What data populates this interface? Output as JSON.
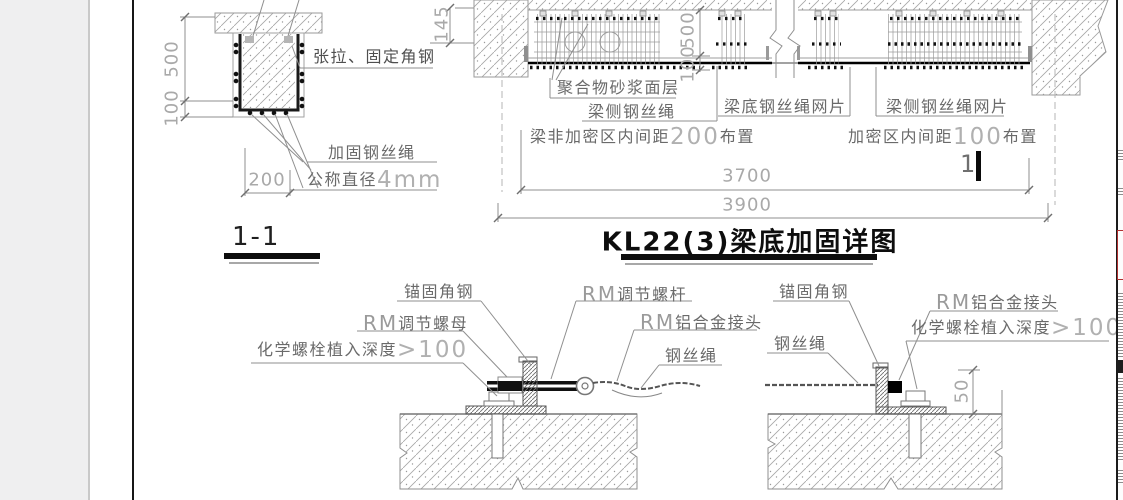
{
  "colors": {
    "line_gray": "#8f8f8f",
    "dim_gray": "#a9a9a9",
    "label_gray": "#6a6a6a",
    "ink_black": "#111111",
    "red_accent": "#b03030",
    "sidebar_gray": "#efeff0"
  },
  "s11": {
    "name": "1-1",
    "d500": "500",
    "d100": "100",
    "d200": "200",
    "tension": "张拉、固定角钢",
    "rope": "加固钢丝绳",
    "dia_prefix": "公称直径",
    "dia_num": "4mm"
  },
  "elev": {
    "title": "KL22(3)梁底加固详图",
    "d145": "145",
    "d500": "500",
    "d100": "100",
    "d3700": "3700",
    "d3900": "3900",
    "mortar": "聚合物砂浆面层",
    "side_rope": "梁侧钢丝绳",
    "bottom_mesh": "梁底钢丝绳网片",
    "side_mesh": "梁侧钢丝绳网片",
    "sp1_prefix": "梁非加密区内间距",
    "sp1_num": "200",
    "sp1_suffix": "布置",
    "sp2_prefix": "加密区内间距",
    "sp2_num": "100",
    "sp2_suffix": "布置",
    "edit_text": "1"
  },
  "dl": {
    "anchor": "锚固角钢",
    "rm": "RM",
    "rod": "调节螺杆",
    "nut": "调节螺母",
    "conn": "铝合金接头",
    "chem_prefix": "化学螺栓植入深度",
    "chem_num": ">100",
    "rope": "钢丝绳"
  },
  "dr": {
    "anchor": "锚固角钢",
    "rope": "钢丝绳",
    "rm": "RM",
    "conn": "铝合金接头",
    "chem_prefix": "化学螺栓植入深度",
    "chem_num": ">100",
    "d50": "50"
  }
}
